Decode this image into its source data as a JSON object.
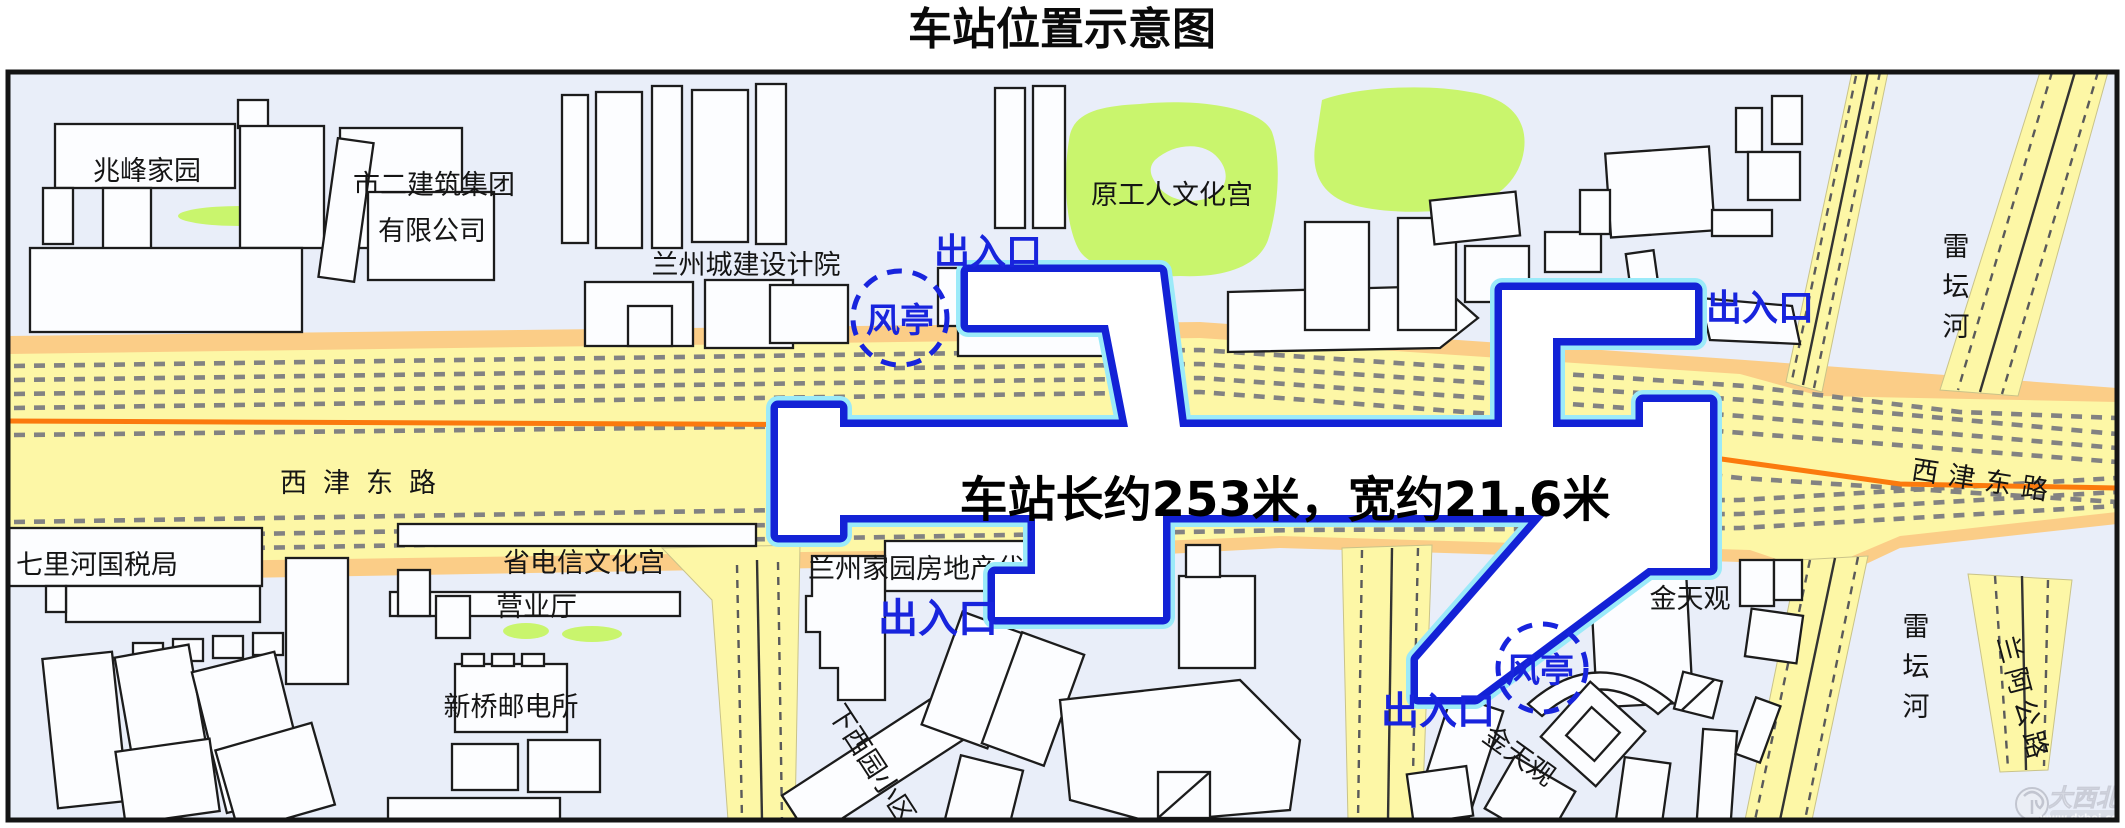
{
  "title": "车站位置示意图",
  "station": {
    "size_note": "车站长约253米，宽约21.6米",
    "entrance": "出入口",
    "vent": "风亭"
  },
  "roads": {
    "xijin_left": "西津东路",
    "xijin_right": "西津东路",
    "leitan_top": "雷坛河",
    "leitan_bottom": "雷坛河",
    "lan_a": "兰阿公路"
  },
  "buildings": {
    "zhaofeng": "兆峰家园",
    "shier_group_line1": "市二建筑集团",
    "shier_group_line2": "有限公司",
    "chengjian": "兰州城建设计院",
    "wenhuagong": "原工人文化宫",
    "guoshuiju": "七里河国税局",
    "dianxin_line1": "省电信文化宫",
    "dianxin_line2": "营业厅",
    "youdiansuo": "新桥邮电所",
    "lzjiayuan": "兰州家园房地产代理公司",
    "xiaxiyuan": "下西园小区",
    "jiujianlou": "九间楼",
    "jintianguan_upper": "金天观",
    "jintianguan_lower": "金天观"
  },
  "watermark": {
    "brand": "大西北",
    "site": "www.dxbei.com"
  },
  "colors": {
    "station_outline": "#1322d6",
    "station_glow": "#9beaf9",
    "road_fill": "#fdf7a6",
    "road_edge": "#fbcd87",
    "center_line": "#fb7a0d",
    "green_area": "#c9f56d",
    "label_blue": "#1824dd",
    "background": "#e9eef9"
  }
}
